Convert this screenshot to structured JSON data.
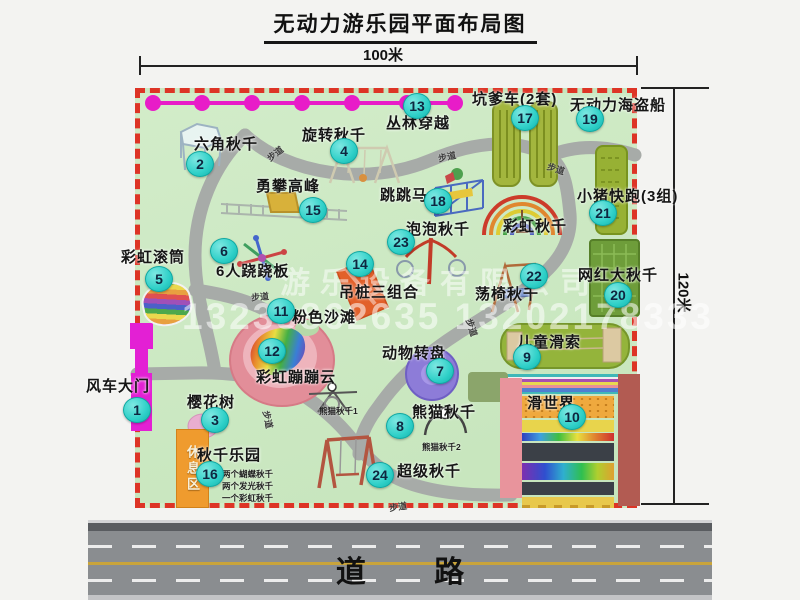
{
  "title": "无动力游乐园平面布局图",
  "dimensions": {
    "top": "100米",
    "right": "120米"
  },
  "road": {
    "label": "道 路"
  },
  "watermark": {
    "company": "游乐设备有限公司",
    "phone": "13233862635 13202178333"
  },
  "walkway_label": "步道",
  "rest_area_label": "休息区",
  "attractions": [
    {
      "num": "1",
      "name": "风车大门"
    },
    {
      "num": "2",
      "name": "六角秋千"
    },
    {
      "num": "3",
      "name": "樱花树"
    },
    {
      "num": "4",
      "name": "旋转秋千"
    },
    {
      "num": "5",
      "name": "彩虹滚筒"
    },
    {
      "num": "6",
      "name": "6人跷跷板"
    },
    {
      "num": "7",
      "name": "动物转盘"
    },
    {
      "num": "8",
      "name": "熊猫秋千",
      "sublabels": [
        "熊猫秋千1",
        "熊猫秋千2"
      ]
    },
    {
      "num": "9",
      "name": "儿童滑索"
    },
    {
      "num": "10",
      "name": "滑世界"
    },
    {
      "num": "11",
      "name": "粉色沙滩"
    },
    {
      "num": "12",
      "name": "彩虹蹦蹦云"
    },
    {
      "num": "13",
      "name": "丛林穿越"
    },
    {
      "num": "14",
      "name": "吊桩三组合"
    },
    {
      "num": "15",
      "name": "勇攀高峰"
    },
    {
      "num": "16",
      "name": "秋千乐园",
      "sublabels": [
        "两个蝴蝶秋千",
        "两个发光秋千",
        "一个彩虹秋千"
      ]
    },
    {
      "num": "17",
      "name": "坑爹车(2套)"
    },
    {
      "num": "18",
      "name": "跳跳马"
    },
    {
      "num": "19",
      "name": "无动力海盗船"
    },
    {
      "num": "20",
      "name": "网红大秋千"
    },
    {
      "num": "21",
      "name": "小猪快跑(3组)"
    },
    {
      "num": "22",
      "name": "荡椅秋千"
    },
    {
      "num": "23",
      "name": "泡泡秋千"
    },
    {
      "num": "24",
      "name": "超级秋千"
    }
  ],
  "unnumbered_labels": [
    "彩虹秋千"
  ],
  "colors": {
    "map_background": "#cde9c5",
    "map_border_red": "#dd3426",
    "badge_cyan": "#2fd0c8",
    "zipline_magenta": "#e81cc8",
    "gate_magenta": "#e320d4",
    "rest_area_orange": "#ef9b2e",
    "road_gray": "#8a8d90",
    "road_line_yellow": "#c9a43b"
  }
}
